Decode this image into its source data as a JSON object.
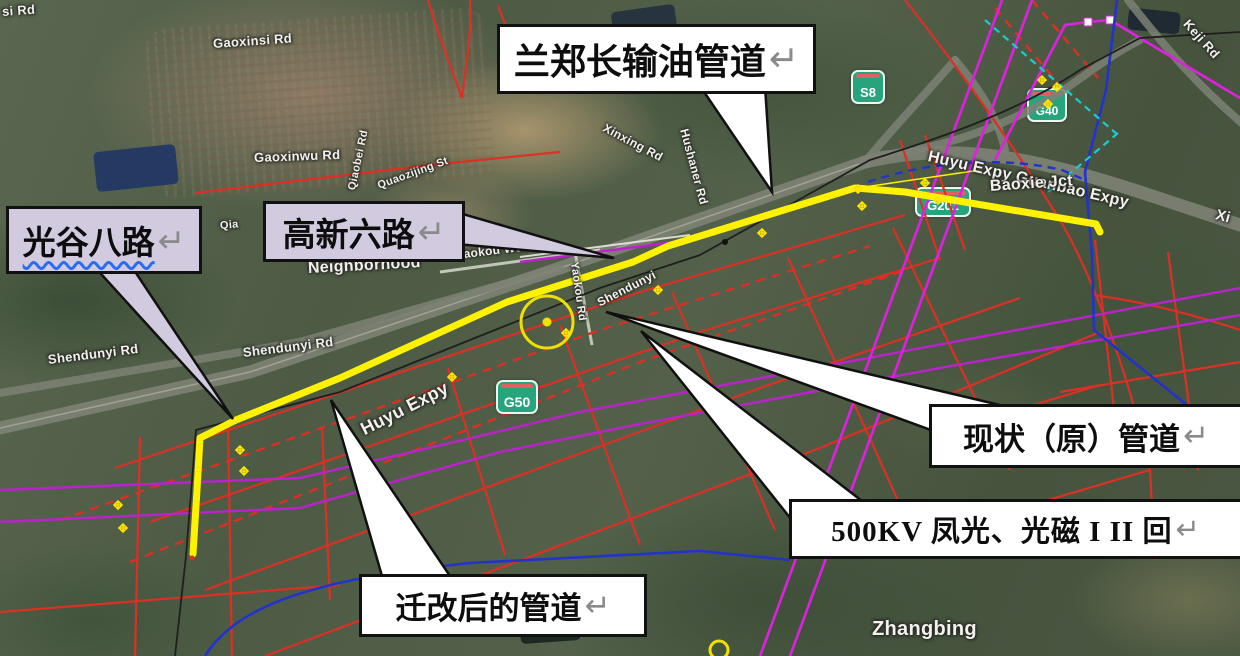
{
  "callouts": {
    "lanzheng": {
      "text": "兰郑长输油管道",
      "arrow": "↵"
    },
    "guanggu": {
      "text": "光谷八路",
      "arrow": "↵"
    },
    "gaoxin": {
      "text": "高新六路",
      "arrow": "↵"
    },
    "xianzhuang": {
      "text": "现状（原）管道",
      "arrow": "↵"
    },
    "kv500": {
      "text": "500KV 凤光、光磁 I II 回",
      "arrow": "↵"
    },
    "qiangai": {
      "text": "迁改后的管道",
      "arrow": "↵"
    }
  },
  "badges": {
    "s8": "S8",
    "g50": "G50",
    "g201": "G201",
    "g40": "G40"
  },
  "map_labels": [
    {
      "text": "si Rd",
      "x": 2,
      "y": 4,
      "rot": -4,
      "size": 13
    },
    {
      "text": "Gaoxinsi Rd",
      "x": 213,
      "y": 36,
      "rot": -4,
      "size": 13
    },
    {
      "text": "Gaoxinwu Rd",
      "x": 254,
      "y": 150,
      "rot": -2,
      "size": 13
    },
    {
      "text": "Qiaobei Rd",
      "x": 352,
      "y": 184,
      "rot": -78,
      "size": 11
    },
    {
      "text": "Quaozijing St",
      "x": 378,
      "y": 180,
      "rot": -20,
      "size": 11
    },
    {
      "text": "Qia",
      "x": 220,
      "y": 220,
      "rot": -5,
      "size": 11
    },
    {
      "text": "Xinxing Rd",
      "x": 604,
      "y": 120,
      "rot": 28,
      "size": 12
    },
    {
      "text": "Hushaner Rd",
      "x": 684,
      "y": 122,
      "rot": 75,
      "size": 12
    },
    {
      "text": "Neighborhood",
      "x": 308,
      "y": 260,
      "rot": -3,
      "size": 16
    },
    {
      "text": "Yaokou West St",
      "x": 456,
      "y": 248,
      "rot": -7,
      "size": 12
    },
    {
      "text": "Yaokou Rd",
      "x": 574,
      "y": 256,
      "rot": 82,
      "size": 11
    },
    {
      "text": "Shendunyi",
      "x": 598,
      "y": 296,
      "rot": -27,
      "size": 12
    },
    {
      "text": "Shendunyi Rd",
      "x": 48,
      "y": 352,
      "rot": -7,
      "size": 13
    },
    {
      "text": "Shendunyi Rd",
      "x": 243,
      "y": 345,
      "rot": -7,
      "size": 13
    },
    {
      "text": "Huyu Expy",
      "x": 362,
      "y": 420,
      "rot": -27,
      "size": 18
    },
    {
      "text": "Huyu Expy Guanbao Expy",
      "x": 928,
      "y": 148,
      "rot": 13,
      "size": 16
    },
    {
      "text": "Baoxie Jct",
      "x": 990,
      "y": 178,
      "rot": -4,
      "size": 16
    },
    {
      "text": "Keji Rd",
      "x": 1186,
      "y": 14,
      "rot": 48,
      "size": 13
    },
    {
      "text": "Xi",
      "x": 1216,
      "y": 206,
      "rot": 15,
      "size": 15
    },
    {
      "text": "Zhangbing",
      "x": 872,
      "y": 618,
      "rot": 0,
      "size": 20
    }
  ],
  "markers": [
    [
      118,
      505
    ],
    [
      123,
      528
    ],
    [
      240,
      450
    ],
    [
      244,
      471
    ],
    [
      452,
      377
    ],
    [
      566,
      333
    ],
    [
      658,
      290
    ],
    [
      762,
      233
    ],
    [
      858,
      189
    ],
    [
      862,
      206
    ],
    [
      925,
      183
    ],
    [
      938,
      200
    ],
    [
      1042,
      80
    ],
    [
      1057,
      87
    ],
    [
      1048,
      104
    ]
  ],
  "colors": {
    "accent_yellow": "#FFF200",
    "red": "#DD2F23",
    "magenta": "#E020E0",
    "powerline_purple": "#BB22CC",
    "blue": "#2233CC",
    "cyan": "#19CCD4",
    "black_line": "#1F1F1F",
    "road_gray": "#7D8174",
    "badge_green": "#26A57D",
    "badge_stripe": "#E26060",
    "callout_lavender": "#D2CBDF",
    "label_white": "#F2F2EA"
  }
}
